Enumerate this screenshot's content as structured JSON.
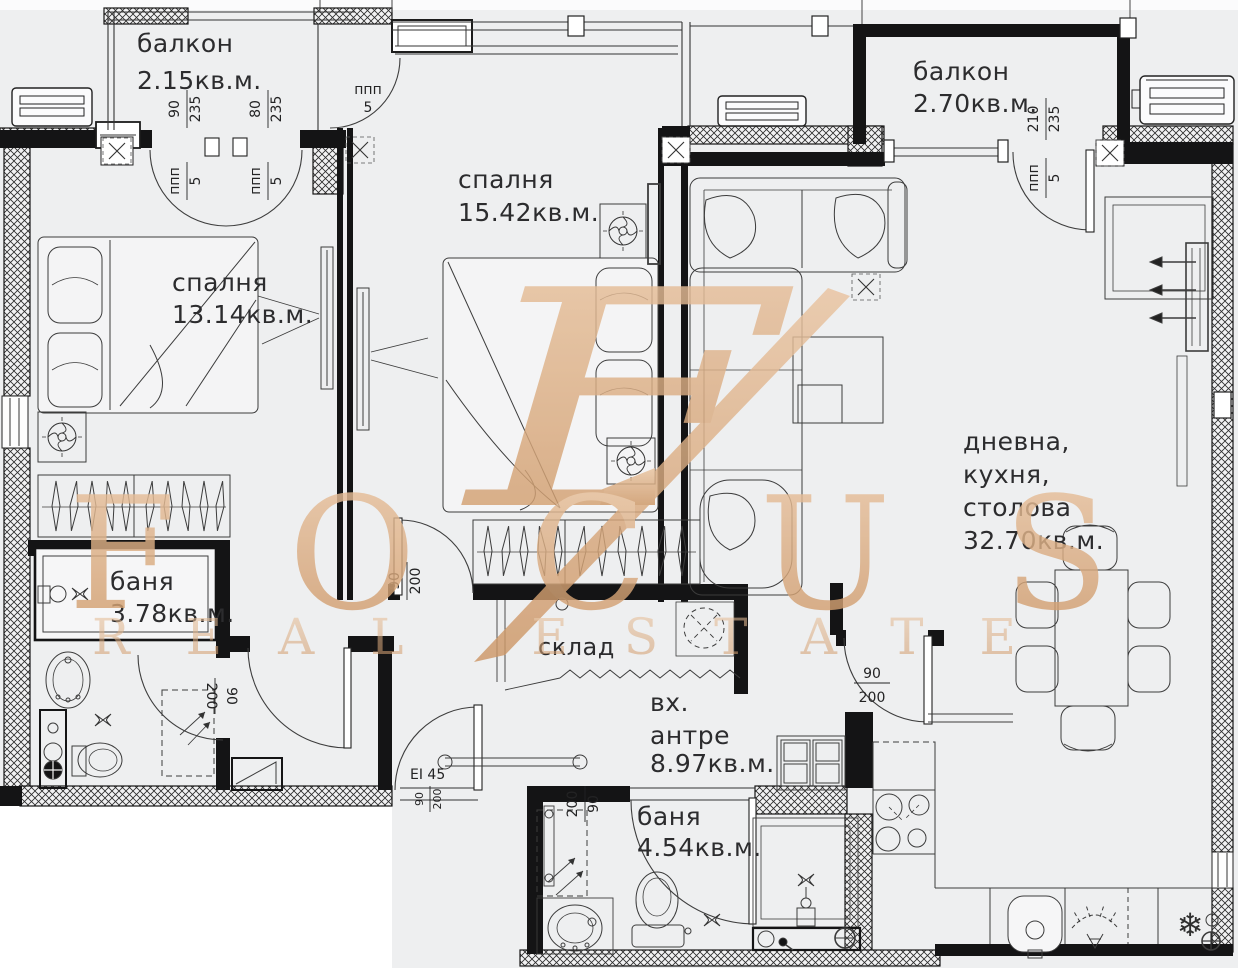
{
  "watermark": {
    "monogram": "F",
    "title": "FOCUS",
    "subtitle": "REAL ESTATE",
    "color": "#d9a87c"
  },
  "rooms": {
    "balcony_left": {
      "name": "балкон",
      "area": "2.15кв.м."
    },
    "bedroom_top": {
      "name": "спалня",
      "area": "15.42кв.м."
    },
    "balcony_right": {
      "name": "балкон",
      "area": "2.70кв.м."
    },
    "bedroom_left": {
      "name": "спалня",
      "area": "13.14кв.м."
    },
    "bath_left": {
      "name": "баня",
      "area": "3.78кв.м."
    },
    "living": {
      "line1": "дневна,",
      "line2": "кухня,",
      "line3": "столова",
      "area": "32.70кв.м."
    },
    "storage": {
      "name": "склад"
    },
    "entry": {
      "line1": "вх.",
      "line2": "антре",
      "area": "8.97кв.м."
    },
    "bath_bottom": {
      "name": "баня",
      "area": "4.54кв.м."
    }
  },
  "dims": {
    "d90": "90",
    "d80": "80",
    "d210": "210",
    "d235": "235",
    "d200": "200",
    "d5": "5",
    "ppp": "ппп",
    "door_rating": "EI 45"
  },
  "icons": {
    "fridge_snowflake": "❄"
  }
}
